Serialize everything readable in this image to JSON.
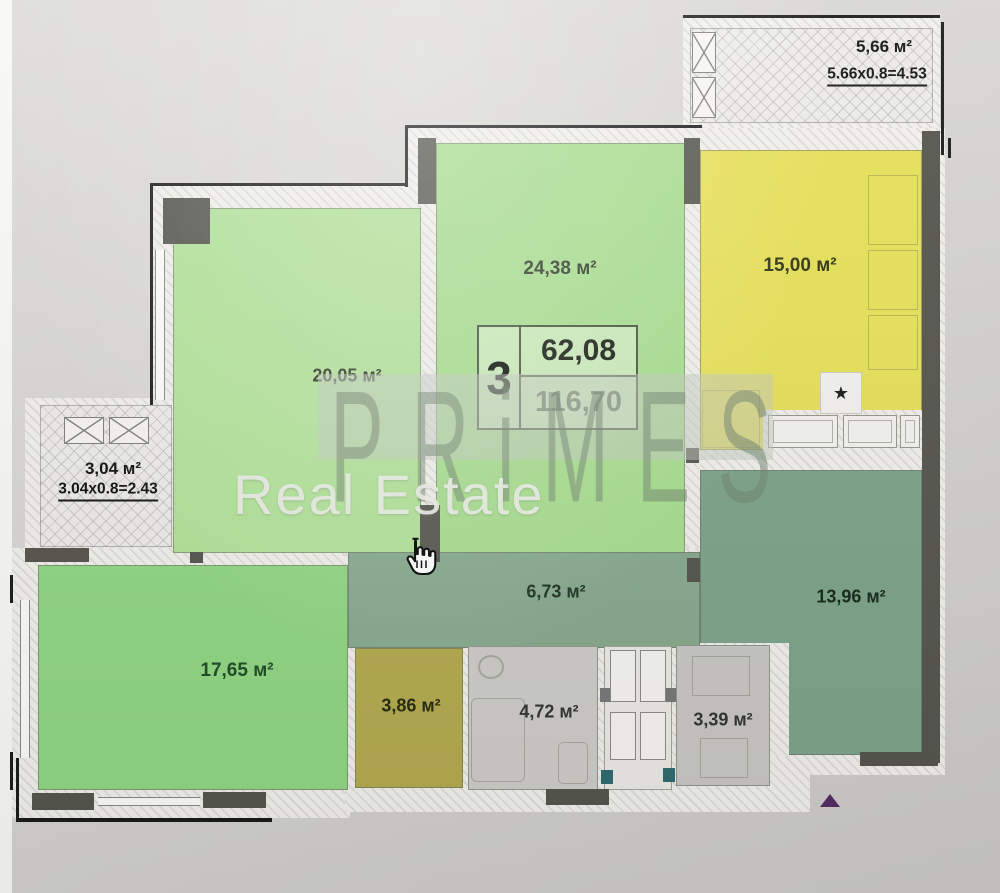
{
  "plan": {
    "info_box": {
      "rooms_count": "3",
      "area_living": "62,08",
      "area_total": "116,70"
    },
    "rooms": {
      "r2005": {
        "label": "20,05 м²"
      },
      "r2438": {
        "label": "24,38 м²"
      },
      "kitchen": {
        "label": "15,00 м²"
      },
      "r1765": {
        "label": "17,65 м²"
      },
      "hall": {
        "label": "6,73 м²"
      },
      "r1396": {
        "label": "13,96 м²"
      },
      "s386": {
        "label": "3,86 м²"
      },
      "bath": {
        "label": "4,72 м²"
      },
      "wc": {
        "label": "3,39 м²"
      },
      "balcony_top": {
        "label": "5,66 м²",
        "formula": "5.66x0.8=4.53"
      },
      "balcony_left": {
        "label": "3,04 м²",
        "formula": "3.04x0.8=2.43"
      }
    },
    "symbols": {
      "star": "★",
      "triangle": "▲"
    }
  },
  "watermark": {
    "brand": "PRiMES",
    "subtitle": "Real Estate"
  },
  "colors": {
    "room_green_light": "#b1e298",
    "room_green": "#a7dd8e",
    "room_green_mid": "#90d683",
    "hall_sage": "#87aa8e",
    "room_sage_dark": "#7da389",
    "kitchen_yellow": "#e7e158",
    "storage_olive": "#b4aa4f",
    "bath_gray": "#cdccc8",
    "wc_gray": "#c8c7c3",
    "wall_dark": "#54554d",
    "accent_teal": "#2f6b6e",
    "triangle_purple": "#542b63"
  }
}
